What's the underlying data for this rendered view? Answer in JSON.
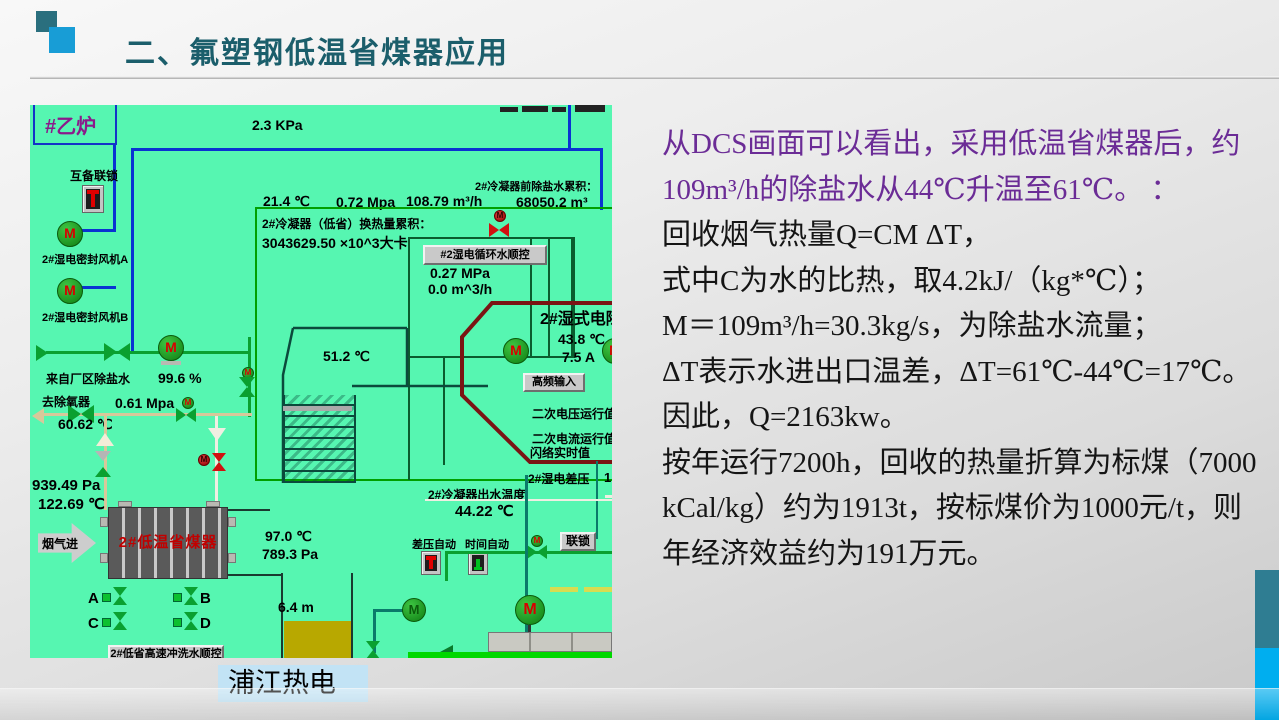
{
  "slide": {
    "title": "二、氟塑钢低温省煤器应用",
    "caption": "浦江热电"
  },
  "body": {
    "lines": [
      {
        "text": "从DCS画面可以看出，采用低温省煤器后，约",
        "purple": true
      },
      {
        "text": "109m³/h的除盐水从44℃升温至61℃。 ：",
        "purple": true
      },
      {
        "text": "回收烟气热量Q=CM ΔT，",
        "purple": false
      },
      {
        "text": "式中C为水的比热，取4.2kJ/（kg*℃）；",
        "purple": false
      },
      {
        "text": "M＝109m³/h=30.3kg/s，为除盐水流量；",
        "purple": false
      },
      {
        "text": "ΔT表示水进出口温差，ΔT=61℃-44℃=17℃。",
        "purple": false
      },
      {
        "text": "因此，Q=2163kw。",
        "purple": false
      },
      {
        "text": "按年运行7200h，回收的热量折算为标煤（7000",
        "purple": false
      },
      {
        "text": "kCal/kg）约为1913t，按标煤价为1000元/t，则",
        "purple": false
      },
      {
        "text": "年经济效益约为191万元。",
        "purple": false
      }
    ]
  },
  "dcs": {
    "boiler": "#乙炉",
    "kpa": "2.3 KPa",
    "interlock": "互备联锁",
    "fan_a": "2#湿电密封风机A",
    "fan_b": "2#湿电密封风机B",
    "t214": "21.4 ℃",
    "p072": "0.72 Mpa",
    "f10879": "108.79 m³/h",
    "pre_label": "2#冷凝器前除盐水累积：",
    "pre_value": "68050.2 m³",
    "heat_label": "2#冷凝器（低省）换热量累积：",
    "heat_value": "3043629.50 ×10^3大卡",
    "seq_btn": "#2湿电循环水顺控",
    "p027": "0.27 MPa",
    "f00": "0.0 m^3/h",
    "t512": "51.2 ℃",
    "esp": "2#湿式电除尘",
    "t438": "43.8 ℃",
    "a75": "7.5 A",
    "hf_btn": "高频输入",
    "v2": "二次电压运行值",
    "i2": "二次电流运行值",
    "flash": "闪络实时值",
    "dp": "2#湿电差压",
    "dp_val": "1",
    "out_t_label": "2#冷凝器出水温度",
    "out_t": "44.22 ℃",
    "dp_auto": "差压自动",
    "time_auto": "时间自动",
    "lock_btn": "联锁",
    "from_plant": "来自厂区除盐水",
    "pct996": "99.6 %",
    "deaerator": "去除氧器",
    "p061": "0.61 Mpa",
    "t6062": "60.62 ℃",
    "p93949": "939.49 Pa",
    "t12269": "122.69 ℃",
    "flue": "烟气进",
    "eco": "2#低温省煤器",
    "t970": "97.0 ℃",
    "p7893": "789.3 Pa",
    "va": "A",
    "vb": "B",
    "vc": "C",
    "vd": "D",
    "flush_btn": "2#低省高速冲洗水顺控",
    "level": "6.4 m"
  },
  "colors": {
    "dcs_bg": "#56f6b1",
    "title_teal": "#1b5e6b",
    "purple": "#6b2c96",
    "edge_teal": "#2f7d92",
    "edge_blue": "#00aeef"
  }
}
